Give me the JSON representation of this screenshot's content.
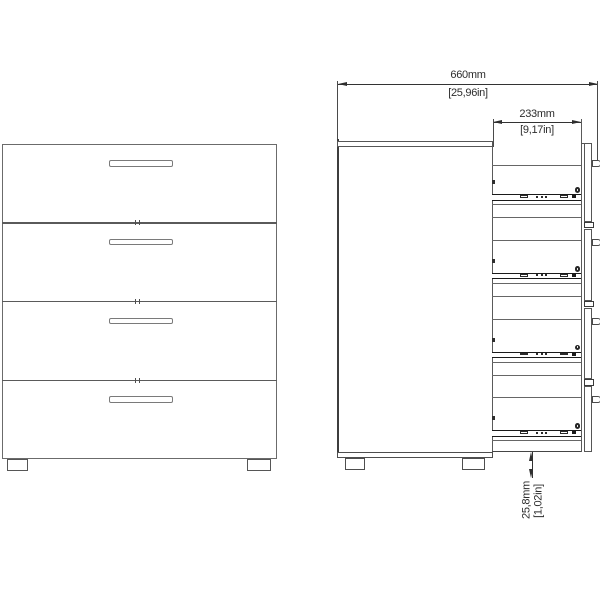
{
  "diagram": {
    "description": "dimension drawing of a four-drawer chest: front view and side view",
    "views": {
      "front": {
        "drawer_count": 4
      },
      "side": {
        "drawer_count": 4
      }
    },
    "dimensions": {
      "overall": {
        "metric": "660mm",
        "imperial": "[25,96in]"
      },
      "drawer_depth": {
        "metric": "233mm",
        "imperial": "[9,17in]"
      },
      "base_clearance": {
        "metric": "25,8mm",
        "imperial": "[1,02in]"
      }
    },
    "colors": {
      "background": "#ffffff",
      "line": "#5a5a5a",
      "line_dark": "#2e2e2e",
      "hardware": "#1a1a1a",
      "text": "#2d2d2d"
    }
  }
}
